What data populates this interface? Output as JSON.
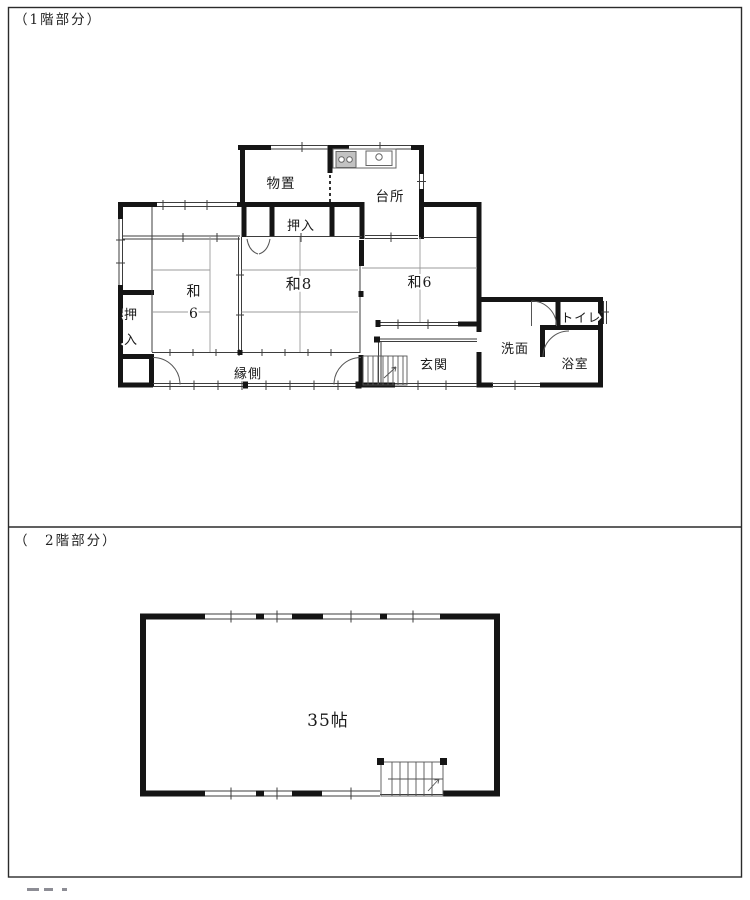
{
  "sections": {
    "floor1_label": "（1階部分）",
    "floor2_label": "（　2階部分）"
  },
  "floor1": {
    "rooms": {
      "storage": "物置",
      "kitchen": "台所",
      "closet_top": "押入",
      "closet_left_char1": "押",
      "closet_left_char2": "入",
      "washitsu6_left_char1": "和",
      "washitsu6_left_char2": "6",
      "washitsu8": "和8",
      "washitsu6_right": "和6",
      "engawa": "縁側",
      "entrance": "玄関",
      "washroom": "洗面",
      "toilet": "トイレ",
      "bath": "浴室"
    }
  },
  "floor2": {
    "room_size": "35帖"
  }
}
